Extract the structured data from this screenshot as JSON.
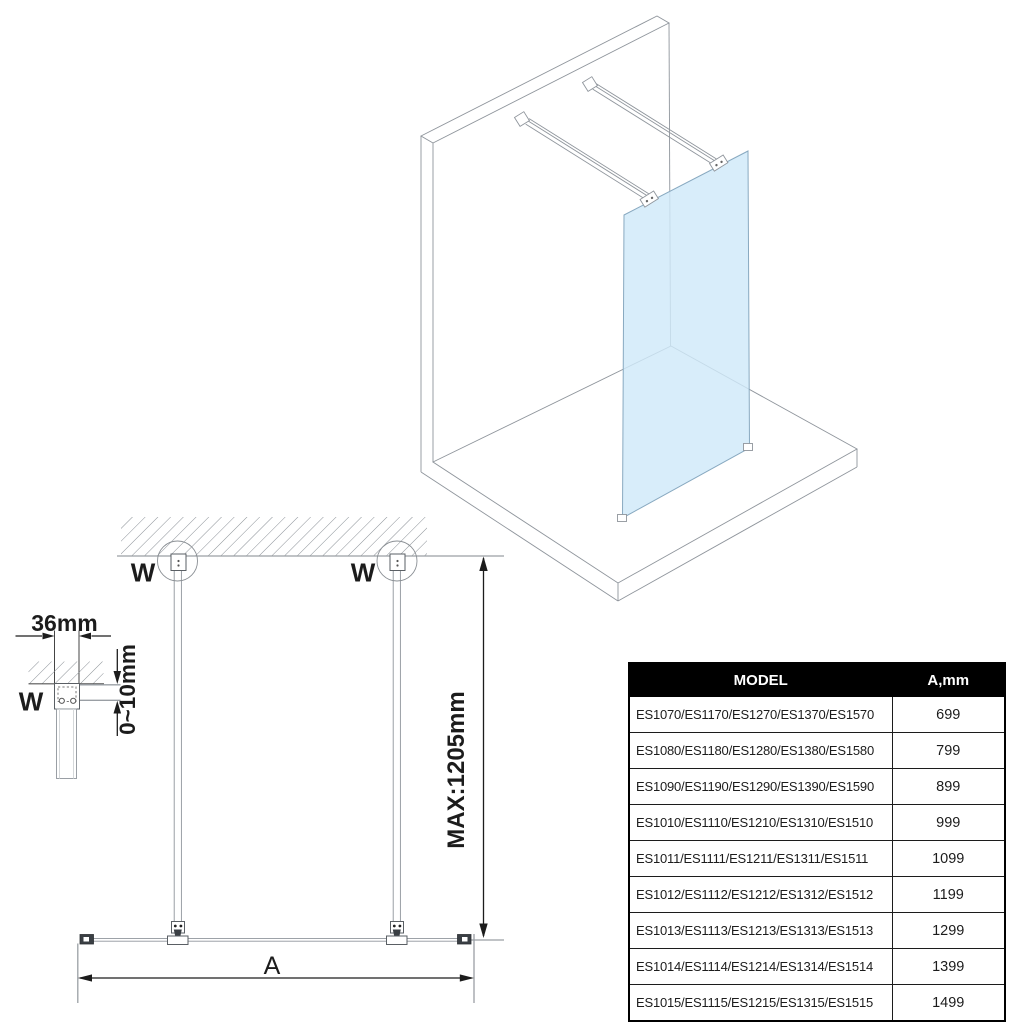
{
  "iso_view": {
    "glass_color": "#cfe9f9",
    "glass_edge_color": "#88a9c0",
    "line_color": "#8f959c"
  },
  "plan_view": {
    "left_bracket_label": "W",
    "right_bracket_label": "W",
    "height_dim_label": "MAX:1205mm",
    "width_dim_label": "A"
  },
  "detail_view": {
    "bracket_width_label": "36mm",
    "gap_label": "0~10mm",
    "bracket_label": "W"
  },
  "spec_table": {
    "header_bg": "#000000",
    "header_fg": "#ffffff",
    "columns": [
      "MODEL",
      "A,mm"
    ],
    "rows": [
      {
        "model": "ES1070/ES1170/ES1270/ES1370/ES1570",
        "a_mm": "699"
      },
      {
        "model": "ES1080/ES1180/ES1280/ES1380/ES1580",
        "a_mm": "799"
      },
      {
        "model": "ES1090/ES1190/ES1290/ES1390/ES1590",
        "a_mm": "899"
      },
      {
        "model": "ES1010/ES1110/ES1210/ES1310/ES1510",
        "a_mm": "999"
      },
      {
        "model": "ES1011/ES1111/ES1211/ES1311/ES1511",
        "a_mm": "1099"
      },
      {
        "model": "ES1012/ES1112/ES1212/ES1312/ES1512",
        "a_mm": "1199"
      },
      {
        "model": "ES1013/ES1113/ES1213/ES1313/ES1513",
        "a_mm": "1299"
      },
      {
        "model": "ES1014/ES1114/ES1214/ES1314/ES1514",
        "a_mm": "1399"
      },
      {
        "model": "ES1015/ES1115/ES1215/ES1315/ES1515",
        "a_mm": "1499"
      }
    ]
  }
}
